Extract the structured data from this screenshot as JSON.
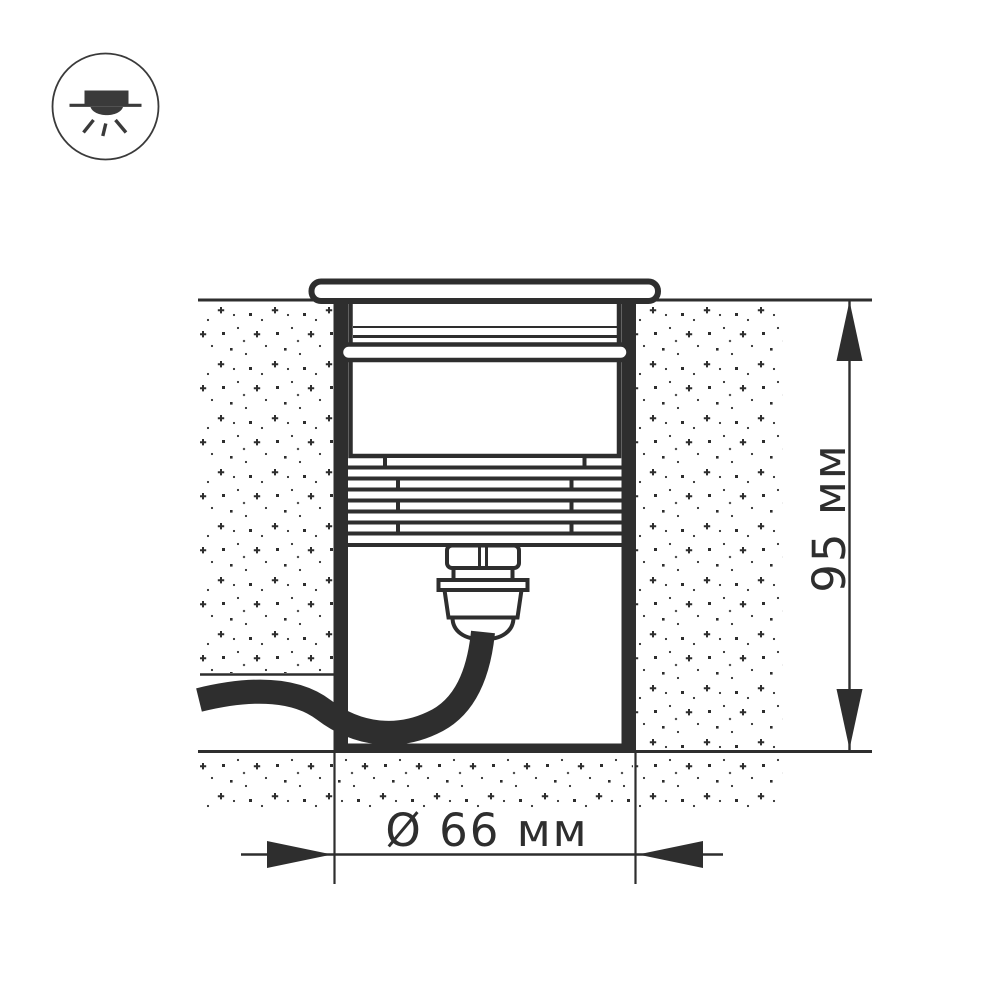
{
  "badge": {
    "icon": "recessed-downlight-icon"
  },
  "drawing": {
    "type": "technical-cross-section",
    "subject": "in-ground recessed luminaire",
    "dimensions": {
      "height_label": "95 мм",
      "diameter_label": "Ø 66 мм"
    },
    "colors": {
      "line": "#2e2e2e",
      "icon_line": "#3a3a3a",
      "background": "#ffffff"
    }
  }
}
